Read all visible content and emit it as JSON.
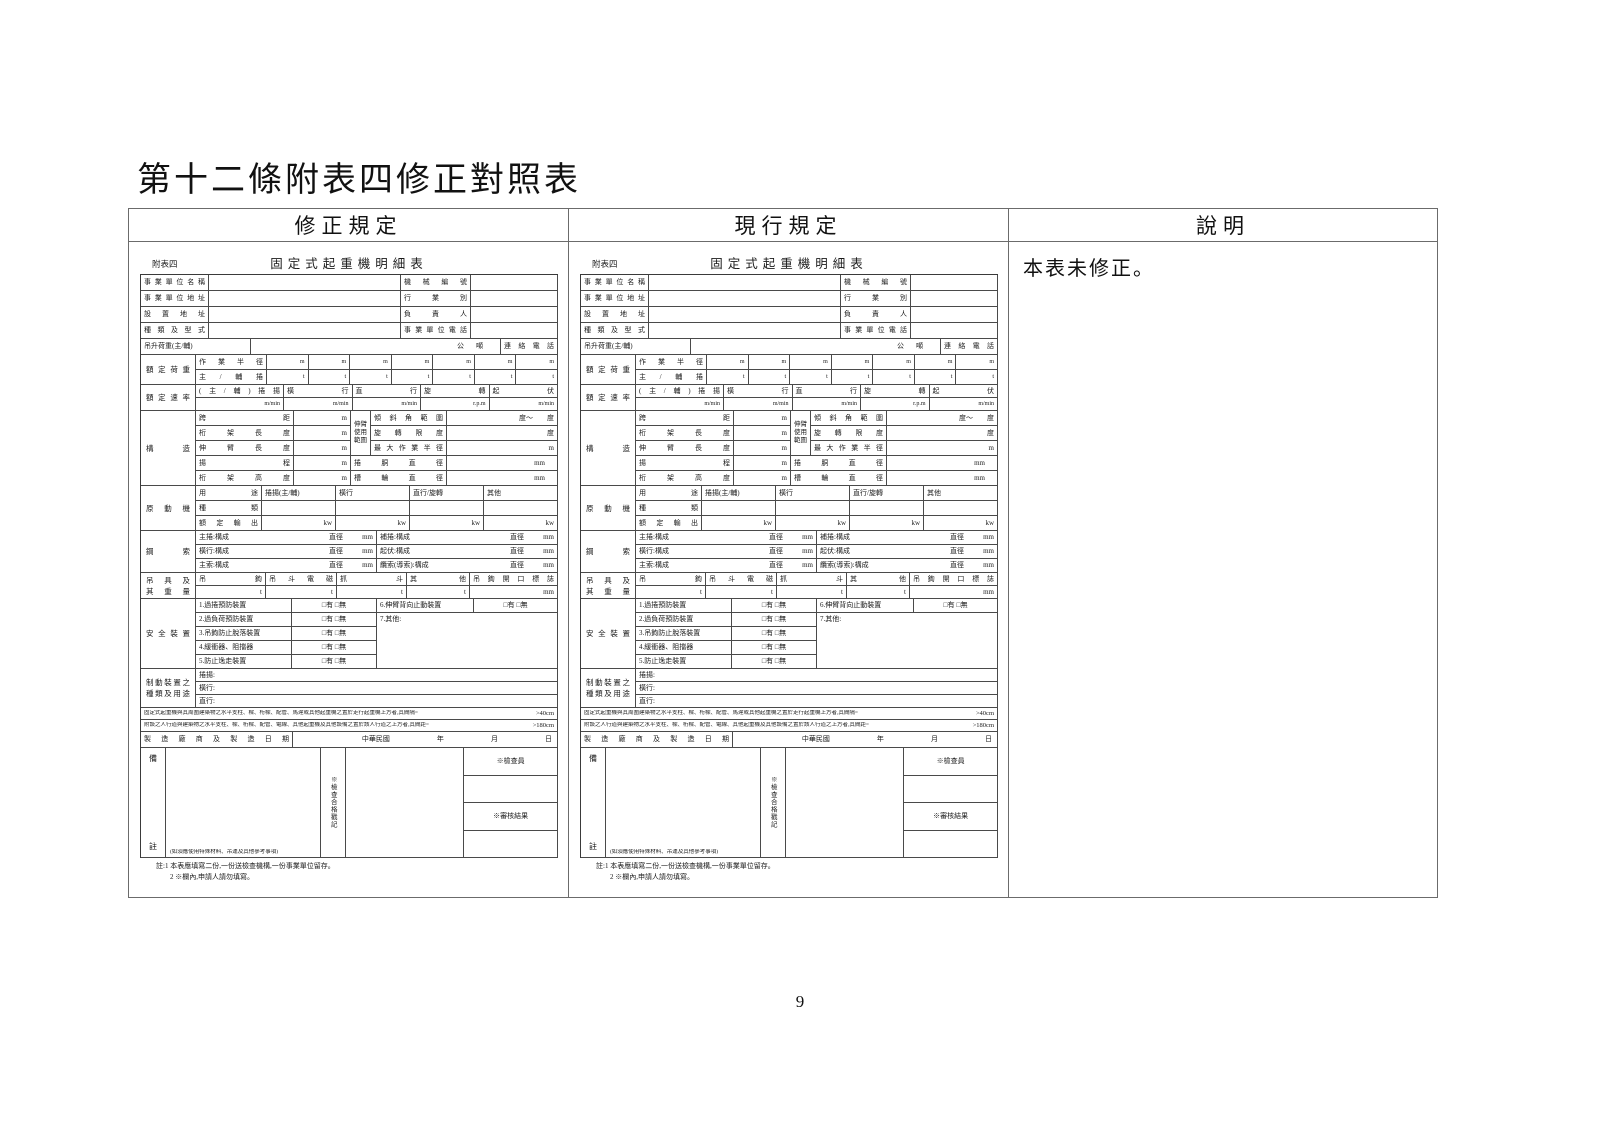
{
  "page": {
    "title": "第十二條附表四修正對照表",
    "page_number": "9"
  },
  "colors": {
    "ink": "#111111",
    "outer_border": "#6b6b6b",
    "form_border": "#4a4a4a"
  },
  "comparison": {
    "columns": [
      "修正規定",
      "現行規定",
      "說明"
    ],
    "explanation": "本表未修正。"
  },
  "form": {
    "appendix_label": "附表四",
    "title": "固定式起重機明細表",
    "info_rows": [
      {
        "l1": "事業單位名稱",
        "l2": "機械編號"
      },
      {
        "l1": "事業單位地址",
        "l2": "行業別"
      },
      {
        "l1": "設置地址",
        "l2": "負責人"
      },
      {
        "l1": "種類及型式",
        "l2": "事業單位電話"
      }
    ],
    "lifting_row": {
      "label": "吊升荷重(主/輔)",
      "unit": "公噸",
      "phone_label": "連絡電話"
    },
    "rated_load": {
      "label": "額定荷重",
      "columns": 7,
      "rows": [
        {
          "label": "作業半徑",
          "unit": "m"
        },
        {
          "label": "主/輔捲",
          "unit": "t"
        }
      ]
    },
    "rated_speed": {
      "label": "額定速率",
      "headers": [
        "(主/輔)捲揚",
        "橫行",
        "直行",
        "旋轉",
        "起伏"
      ],
      "units": [
        "m/min",
        "m/min",
        "m/min",
        "r.p.m",
        "m/min"
      ]
    },
    "structure": {
      "label": "構造",
      "left_rows": [
        {
          "label": "跨距",
          "unit": "m"
        },
        {
          "label": "桁架長度",
          "unit": "m"
        },
        {
          "label": "伸臂長度",
          "unit": "m"
        },
        {
          "label": "揚程",
          "unit": "m"
        },
        {
          "label": "桁架高度",
          "unit": "m"
        }
      ],
      "boom_label": "伸臂使用範圍",
      "boom_rows": [
        {
          "label": "傾斜角範圍",
          "unit": "度～　　度"
        },
        {
          "label": "旋轉限度",
          "unit": "度"
        },
        {
          "label": "最大作業半徑",
          "unit": "m"
        }
      ],
      "drum_rows": [
        {
          "label": "捲胴直徑",
          "unit": "mm"
        },
        {
          "label": "槽輪直徑",
          "unit": "mm"
        }
      ]
    },
    "motor": {
      "label": "原動機",
      "usage_label": "用途",
      "usages": [
        "捲揚(主/輔)",
        "橫行",
        "直行/旋轉",
        "其他"
      ],
      "type_label": "種類",
      "output_label": "額定輸出",
      "output_unit": "kw"
    },
    "rope": {
      "label": "鋼索",
      "dia_label": "直徑",
      "dia_unit": "mm",
      "rows": [
        [
          "主捲:構成",
          "補捲:構成"
        ],
        [
          "橫行:構成",
          "起伏:構成"
        ],
        [
          "主索:構成",
          "纜索(導索):構成"
        ]
      ]
    },
    "gear": {
      "label": "吊具及\n其重量",
      "headers": [
        "吊鉤",
        "吊斗電磁",
        "抓斗",
        "其他",
        "吊鉤開口標誌"
      ],
      "units": [
        "t",
        "t",
        "t",
        "t",
        "mm"
      ]
    },
    "safety": {
      "label": "安全裝置",
      "checkbox": "□有 □無",
      "items_left": [
        "1.過捲預防裝置",
        "2.過負荷預防裝置",
        "3.吊鉤防止脫落裝置",
        "4.緩衝器、阻擋器",
        "5.防止逸走裝置"
      ],
      "item6": "6.伸臂背向止動裝置",
      "item7": "7.其他:"
    },
    "brake": {
      "label": "制動裝置之\n種類及用途",
      "rows": [
        "捲揚:",
        "橫行:",
        "直行:"
      ]
    },
    "clearance_notes": [
      {
        "text": "固定式起重機與其周圍建築物之水平支柱、樑、桁樑、配管、馬達或其他起重機之置於走行起重機上方者,其間隔=",
        "value": ">40cm"
      },
      {
        "text": "附設之人行道與建築物之水平支柱、樑、桁樑、配管、電線、其他起重機及其他設備之置於該人行道之上方者,其間距=",
        "value": ">180cm"
      }
    ],
    "manufacture": {
      "label": "製造廠商及製造日期",
      "era": "中華民國",
      "date_units": [
        "年",
        "月",
        "日"
      ]
    },
    "remarks": {
      "label_top": "備",
      "label_bottom": "註",
      "note": "(如須應使用特殊材料、吊運及其他參考事項)",
      "stamp_label": "※檢查合格戳記",
      "inspector_label": "※檢查員",
      "result_label": "※審核結果"
    },
    "footnotes": [
      "註:1 本表應填寫二份,一份送檢查機構,一份事業單位留存。",
      "2 ※欄內,申請人請勿填寫。"
    ]
  }
}
